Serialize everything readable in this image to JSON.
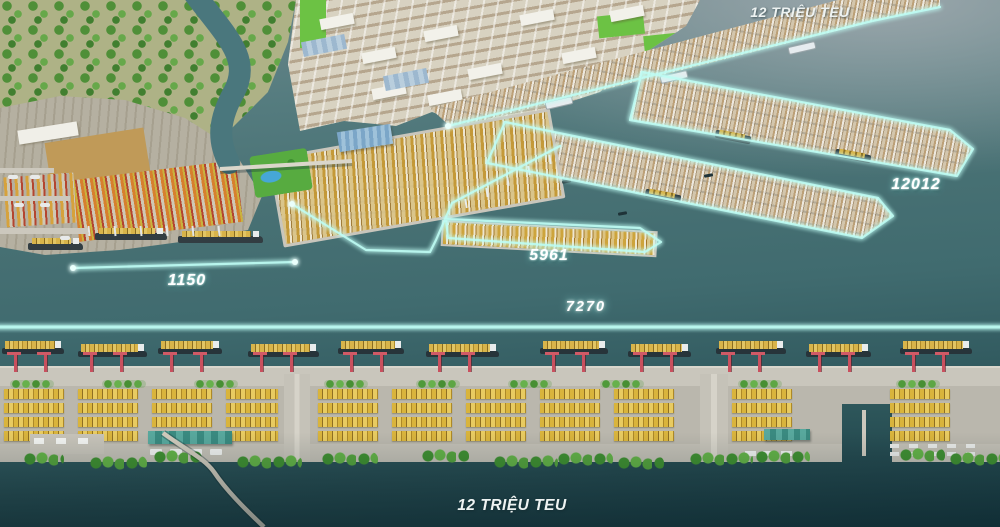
{
  "annotations": {
    "teu_top": "12 TRIỆU TEU",
    "teu_bottom": "12 TRIỆU TEU",
    "dim_quay_left": "1150",
    "dim_terminal_center": "5961",
    "dim_waterfront_total": "7270",
    "dim_pier_right": "12012"
  },
  "colors": {
    "annotation_glow": "#bffdf4",
    "water_upper": "#8fa0a6",
    "water_mid": "#477073",
    "water_lower": "#23484e",
    "container_yellow": "#d9b43c",
    "crane_red": "#c9505e",
    "tree_green": "#4f9a3a",
    "land_beige": "#d8d2c1"
  }
}
